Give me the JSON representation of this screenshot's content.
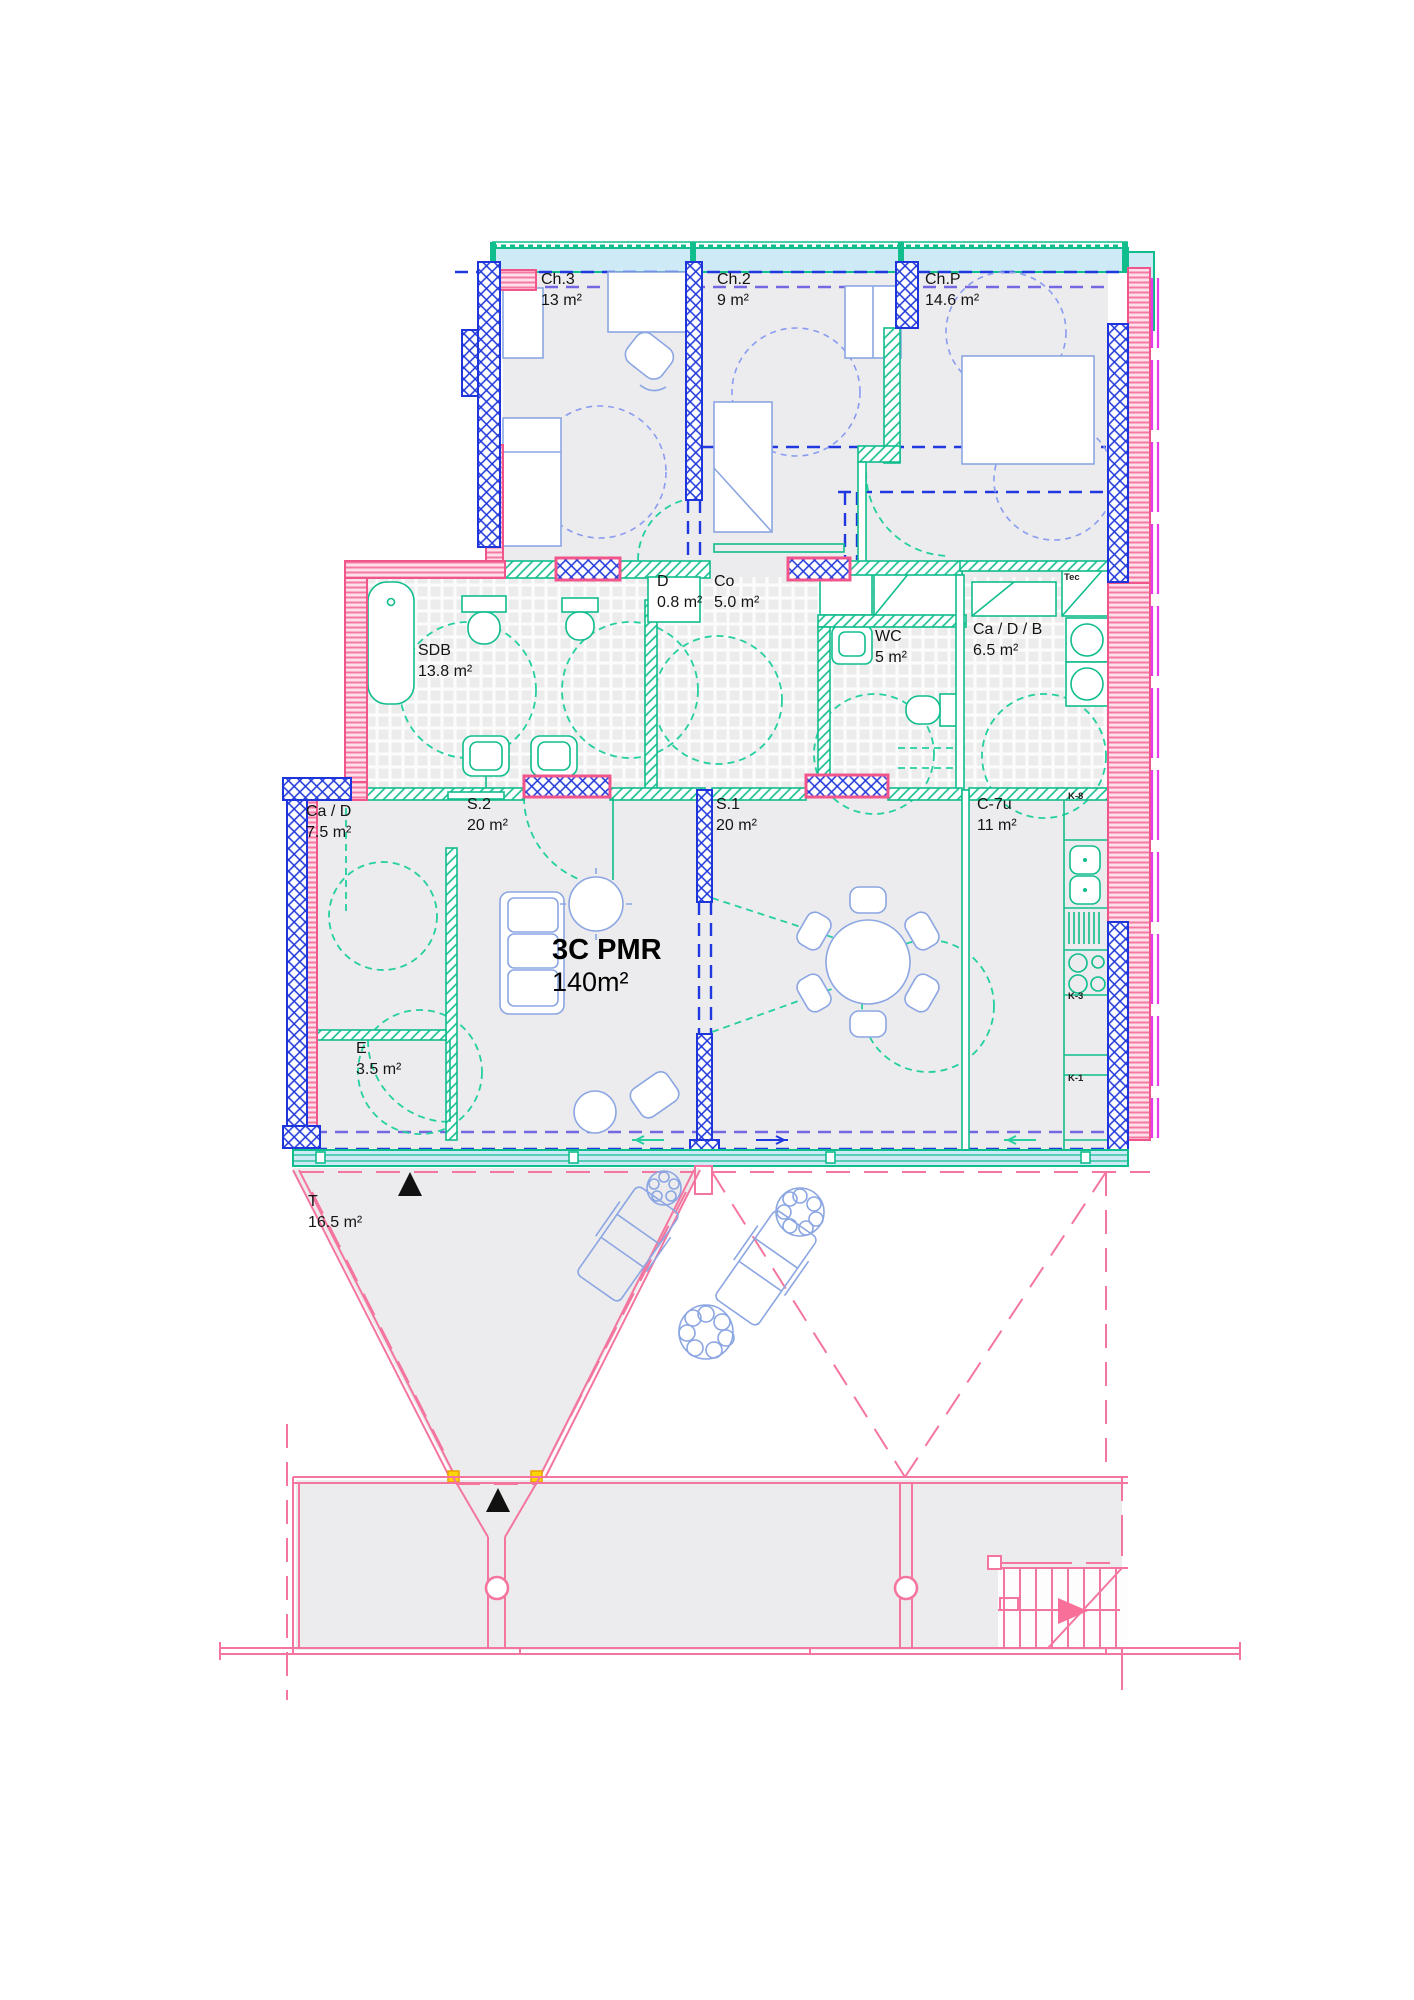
{
  "title": {
    "name": "3C PMR",
    "area": "140m²"
  },
  "rooms": [
    {
      "id": "ch3",
      "label": "Ch.3",
      "area": "13 m²"
    },
    {
      "id": "ch2",
      "label": "Ch.2",
      "area": "9 m²"
    },
    {
      "id": "chp",
      "label": "Ch.P",
      "area": "14.6 m²"
    },
    {
      "id": "sdb",
      "label": "SDB",
      "area": "13.8 m²"
    },
    {
      "id": "d",
      "label": "D",
      "area": "0.8 m²"
    },
    {
      "id": "co",
      "label": "Co",
      "area": "5.0 m²"
    },
    {
      "id": "wc",
      "label": "WC",
      "area": "5 m²"
    },
    {
      "id": "cadb",
      "label": "Ca / D / B",
      "area": "6.5 m²"
    },
    {
      "id": "cad",
      "label": "Ca / D",
      "area": "7.5 m²"
    },
    {
      "id": "s2",
      "label": "S.2",
      "area": "20 m²"
    },
    {
      "id": "s1",
      "label": "S.1",
      "area": "20 m²"
    },
    {
      "id": "c7u",
      "label": "C-7u",
      "area": "11 m²"
    },
    {
      "id": "e",
      "label": "E",
      "area": "3.5 m²"
    },
    {
      "id": "t",
      "label": "T",
      "area": "16.5 m²"
    }
  ],
  "tec": {
    "label": "Tec"
  },
  "kitchen": {
    "units": [
      "K-8",
      "K-3",
      "K-1"
    ]
  },
  "colors": {
    "structural_wall": "#1d35da",
    "insulation_wall": "#f0558c",
    "partition_wall": "#10bd8d",
    "glazing_fill": "#cfeaf7",
    "window_frame": "#e93ae9",
    "furniture": "#8ba6e2",
    "site_lines": "#f4769f",
    "clearance_circle": "#25cfa0",
    "floor_fill": "#ececee",
    "marker_yellow": "#ffd400"
  }
}
